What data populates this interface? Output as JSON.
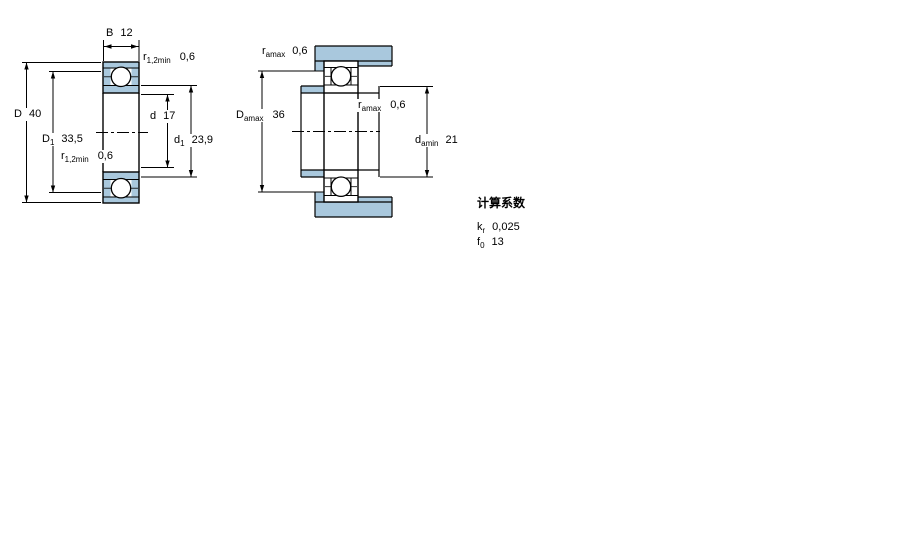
{
  "colors": {
    "section_fill": "#a9c8dd",
    "line": "#000000",
    "background": "#ffffff"
  },
  "left_drawing": {
    "labels": {
      "width": {
        "main": "B",
        "value": "12"
      },
      "r_top": {
        "main": "r",
        "sub": "1,2min",
        "value": "0,6"
      },
      "outer_diameter": {
        "main": "D",
        "value": "40"
      },
      "recess_diameter": {
        "main": "D",
        "sub": "1",
        "value": "33,5"
      },
      "r_bottom": {
        "main": "r",
        "sub": "1,2min",
        "value": "0,6"
      },
      "bore_diameter": {
        "main": "d",
        "value": "17"
      },
      "shoulder_diameter": {
        "main": "d",
        "sub": "1",
        "value": "23,9"
      }
    }
  },
  "middle_drawing": {
    "labels": {
      "fillet_top": {
        "main": "r",
        "sub": "amax",
        "value": "0,6"
      },
      "housing_abutment": {
        "main": "D",
        "sub": "amax",
        "value": "36"
      },
      "fillet_side": {
        "main": "r",
        "sub": "amax",
        "value": "0,6"
      },
      "shaft_abutment": {
        "main": "d",
        "sub": "amin",
        "value": "21"
      }
    }
  },
  "calculation_factors": {
    "title": "计算系数",
    "kr": {
      "main": "k",
      "sub": "r",
      "value": "0,025"
    },
    "f0": {
      "main": "f",
      "sub": "0",
      "value": "13"
    }
  }
}
